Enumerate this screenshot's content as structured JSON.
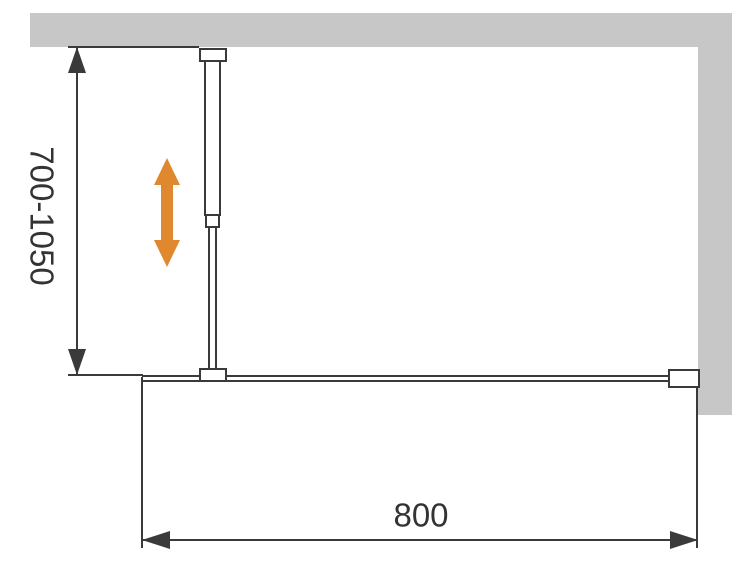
{
  "diagram": {
    "type": "technical-drawing",
    "subject": "walk-in shower glass panel with adjustable wall support bar (plan view)",
    "labels": {
      "vertical_dimension": "700-1050",
      "horizontal_dimension": "800"
    },
    "dimensions": {
      "support_bar_adjustable_range_mm": "700-1050",
      "glass_panel_width_mm": "800"
    },
    "icons": {
      "adjustability_arrow": "double-headed-vertical-arrow"
    },
    "colors": {
      "wall": "#c7c7c7",
      "line": "#3a3a3a",
      "accent_arrow": "#e0882e",
      "text": "#333333",
      "background": "#ffffff"
    }
  }
}
